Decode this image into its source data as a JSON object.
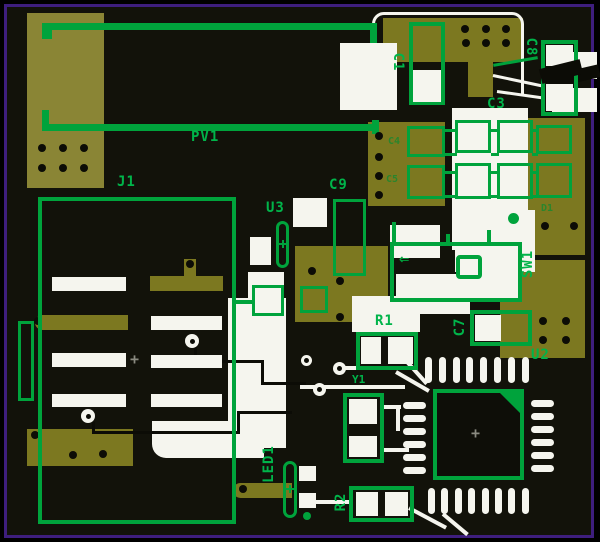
{
  "image_type": "pcb-layout-render",
  "colors": {
    "frame_border": "#3e1e7e",
    "board_background": "#12120a",
    "copper": "#7c7820",
    "copper_light": "#8a8535",
    "silkscreen_green": "#00a33c",
    "label_green": "#00b44a",
    "pad_white": "#f5f5ee",
    "hole_black": "#060604"
  },
  "components": [
    {
      "ref": "PV1"
    },
    {
      "ref": "J1"
    },
    {
      "ref": "U3"
    },
    {
      "ref": "C9"
    },
    {
      "ref": "C1"
    },
    {
      "ref": "C8"
    },
    {
      "ref": "C3"
    },
    {
      "ref": "C4"
    },
    {
      "ref": "C5"
    },
    {
      "ref": "D1"
    },
    {
      "ref": "SW1"
    },
    {
      "ref": "R1"
    },
    {
      "ref": "C7"
    },
    {
      "ref": "U2"
    },
    {
      "ref": "Y1"
    },
    {
      "ref": "R2"
    },
    {
      "ref": "LED1"
    }
  ],
  "glyphs": {
    "switch_arrow": "⇐",
    "center_mark": "+"
  }
}
